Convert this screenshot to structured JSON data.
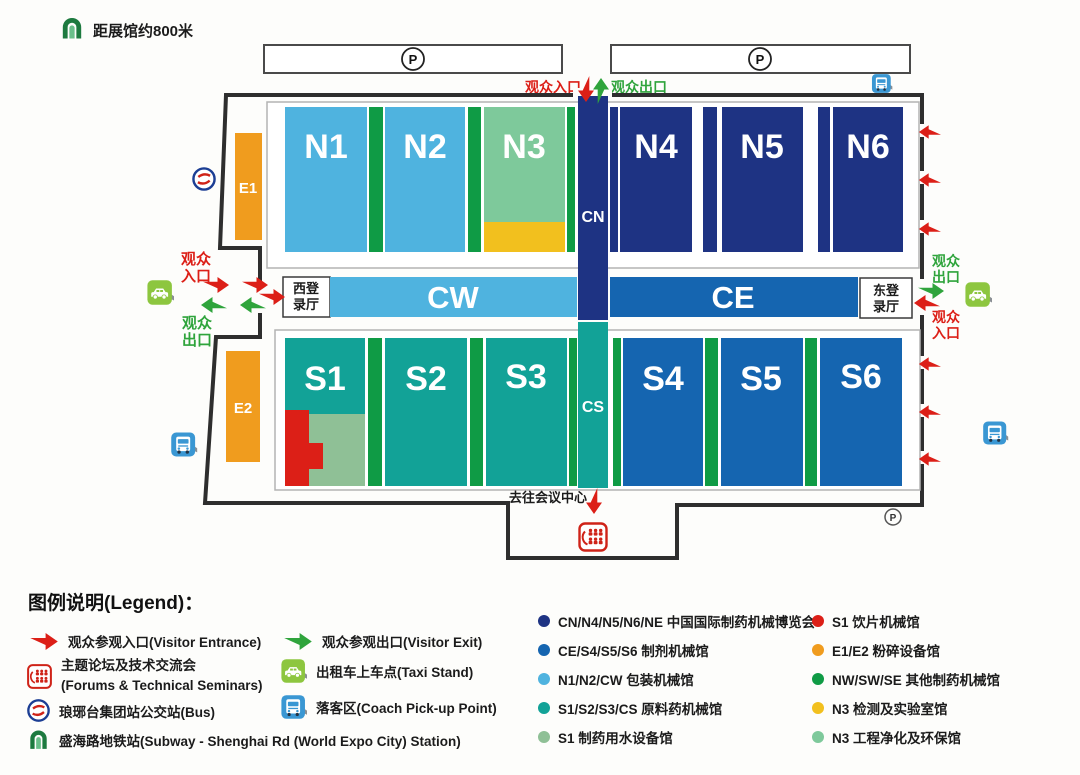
{
  "colors": {
    "navy": "#1e3383",
    "blue": "#1565b0",
    "lightblue": "#4fb3df",
    "teal": "#12a297",
    "sage": "#8fc096",
    "lightgreen": "#7ec99b",
    "darkgreen": "#0f9b45",
    "red": "#dc1f17",
    "green": "#2fa43c",
    "orange": "#f09c1e",
    "yellow": "#f2c01e",
    "taxigreen": "#8dc63f",
    "coachblue": "#3a97d3",
    "buslogoblue": "#1c3e94",
    "buslogored": "#cf2318",
    "metrogreen": "#1d7a3f"
  },
  "map": {
    "distance_note": "距展馆约800米",
    "parking_label": "P",
    "top_gate": {
      "entrance": "观众入口",
      "exit": "观众出口"
    },
    "west_gate": {
      "entrance": [
        "观众",
        "入口"
      ],
      "exit": [
        "观众",
        "出口"
      ]
    },
    "east_gate": {
      "exit": [
        "观众",
        "出口"
      ],
      "entrance": [
        "观众",
        "入口"
      ]
    },
    "registration": {
      "west": [
        "西登",
        "录厅"
      ],
      "east": [
        "东登",
        "录厅"
      ]
    },
    "halls": {
      "n1": "N1",
      "n2": "N2",
      "n3": "N3",
      "n4": "N4",
      "n5": "N5",
      "n6": "N6",
      "s1": "S1",
      "s2": "S2",
      "s3": "S3",
      "s4": "S4",
      "s5": "S5",
      "s6": "S6",
      "cn": "CN",
      "cs": "CS",
      "cw": "CW",
      "ce": "CE",
      "e1": "E1",
      "e2": "E2"
    },
    "conference_note": "去往会议中心"
  },
  "legend": {
    "title": "图例说明(Legend)：",
    "col1": [
      {
        "icon": "entrance-arrow",
        "text": "观众参观入口(Visitor Entrance)"
      },
      {
        "icon": "seminar",
        "text": "主题论坛及技术交流会",
        "text2": "(Forums & Technical Seminars)"
      },
      {
        "icon": "bus-logo",
        "text": "琅琊台集团站公交站(Bus)"
      },
      {
        "icon": "metro-logo",
        "text": "盛海路地铁站(Subway - Shenghai Rd (World Expo City) Station)"
      }
    ],
    "col2": [
      {
        "icon": "exit-arrow",
        "text": "观众参观出口(Visitor Exit)"
      },
      {
        "icon": "taxi",
        "text": "出租车上车点(Taxi Stand)"
      },
      {
        "icon": "coach",
        "text": "落客区(Coach Pick-up Point)"
      }
    ],
    "col3": [
      {
        "color_key": "navy",
        "text": "CN/N4/N5/N6/NE 中国国际制药机械博览会"
      },
      {
        "color_key": "blue",
        "text": "CE/S4/S5/S6 制剂机械馆"
      },
      {
        "color_key": "lightblue",
        "text": "N1/N2/CW 包装机械馆"
      },
      {
        "color_key": "teal",
        "text": "S1/S2/S3/CS 原料药机械馆"
      },
      {
        "color_key": "sage",
        "text": "S1 制药用水设备馆"
      }
    ],
    "col4": [
      {
        "color_key": "red",
        "text": "S1 饮片机械馆"
      },
      {
        "color_key": "orange",
        "text": "E1/E2 粉碎设备馆"
      },
      {
        "color_key": "darkgreen",
        "text": "NW/SW/SE 其他制药机械馆"
      },
      {
        "color_key": "yellow",
        "text": "N3 检测及实验室馆"
      },
      {
        "color_key": "lightgreen",
        "text": "N3 工程净化及环保馆"
      }
    ]
  }
}
